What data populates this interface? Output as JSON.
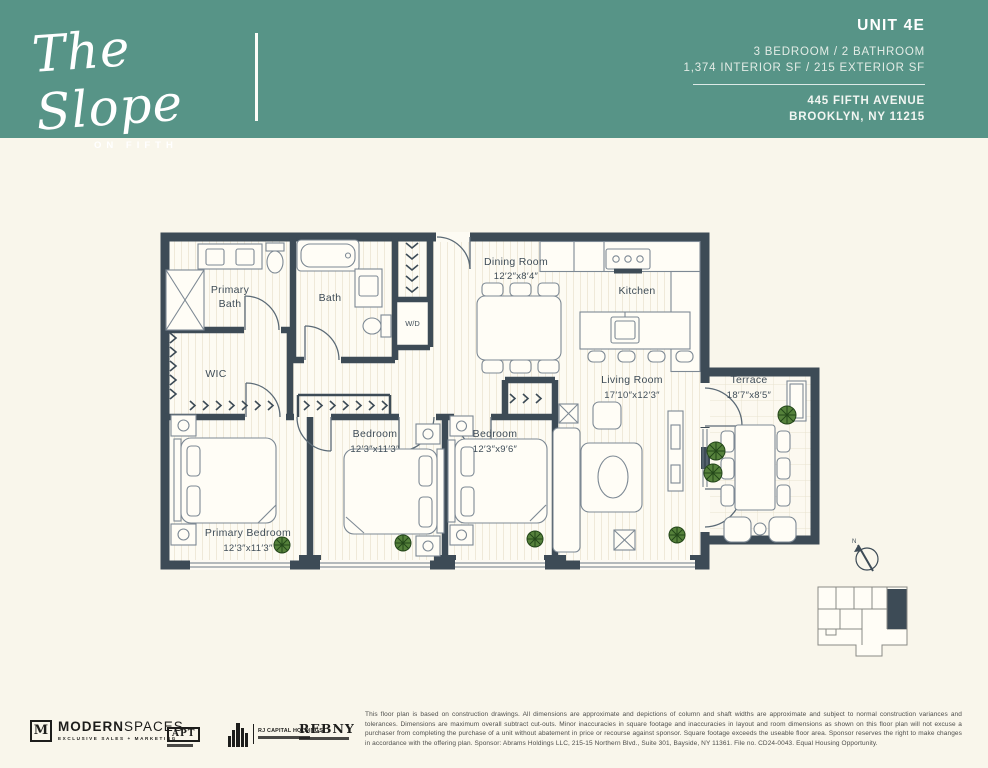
{
  "header": {
    "brand": {
      "script": "The Slope",
      "subtitle": "ON FIFTH"
    },
    "unit_label": "UNIT 4E",
    "specs_rooms": "3 BEDROOM / 2 BATHROOM",
    "specs_area": "1,374 INTERIOR SF / 215 EXTERIOR SF",
    "address_line1": "445 FIFTH AVENUE",
    "address_line2": "BROOKLYN, NY 11215"
  },
  "plan": {
    "rooms": {
      "primary_bath": {
        "line1": "Primary",
        "line2": "Bath"
      },
      "bath": {
        "name": "Bath"
      },
      "laundry": {
        "name": "W/D"
      },
      "wic": {
        "name": "WIC"
      },
      "dining": {
        "name": "Dining Room",
        "dims": "12′2″x8′4″"
      },
      "kitchen": {
        "name": "Kitchen"
      },
      "living": {
        "name": "Living Room",
        "dims": "17′10″x12′3″"
      },
      "terrace": {
        "name": "Terrace",
        "dims": "18′7″x8′5″"
      },
      "bedroom_2": {
        "name": "Bedroom",
        "dims": "12′3″x11′3″"
      },
      "bedroom_3": {
        "name": "Bedroom",
        "dims": "12′3″x9′6″"
      },
      "primary_bedroom": {
        "name": "Primary Bedroom",
        "dims": "12′3″x11′3″"
      }
    },
    "compass": {
      "label": "N"
    },
    "colors": {
      "header_teal": "#579487",
      "page_background": "#f9f6eb",
      "wall": "#3d4b56",
      "floor": "#fdfbf3",
      "plant_green": "#55813b"
    }
  },
  "footer": {
    "logos": {
      "modern_spaces": {
        "monogram": "M",
        "name_bold": "MODERN",
        "name_light": "SPACES",
        "tagline": "EXCLUSIVE SALES + MARKETING"
      },
      "apt": {
        "label": "APT"
      },
      "rj_capital": {
        "name": "RJ CAPITAL HOLDINGS"
      },
      "rebny": {
        "name": "REBNY"
      }
    },
    "disclaimer": "This floor plan is based on construction drawings. All dimensions are approximate and depictions of column and shaft widths are approximate and subject to normal construction variances and tolerances. Dimensions are maximum overall subtract cut-outs. Minor inaccuracies in square footage and inaccuracies in layout and room dimensions as shown on this floor plan will not excuse a purchaser from completing the purchase of a unit without abatement in price or recourse against sponsor. Square footage exceeds the useable floor area. Sponsor reserves the right to make changes in accordance with the offering plan. Sponsor: Abrams Holdings LLC, 215-15 Northern Blvd., Suite 301, Bayside, NY 11361. File no. CD24-0043. Equal Housing Opportunity."
  }
}
